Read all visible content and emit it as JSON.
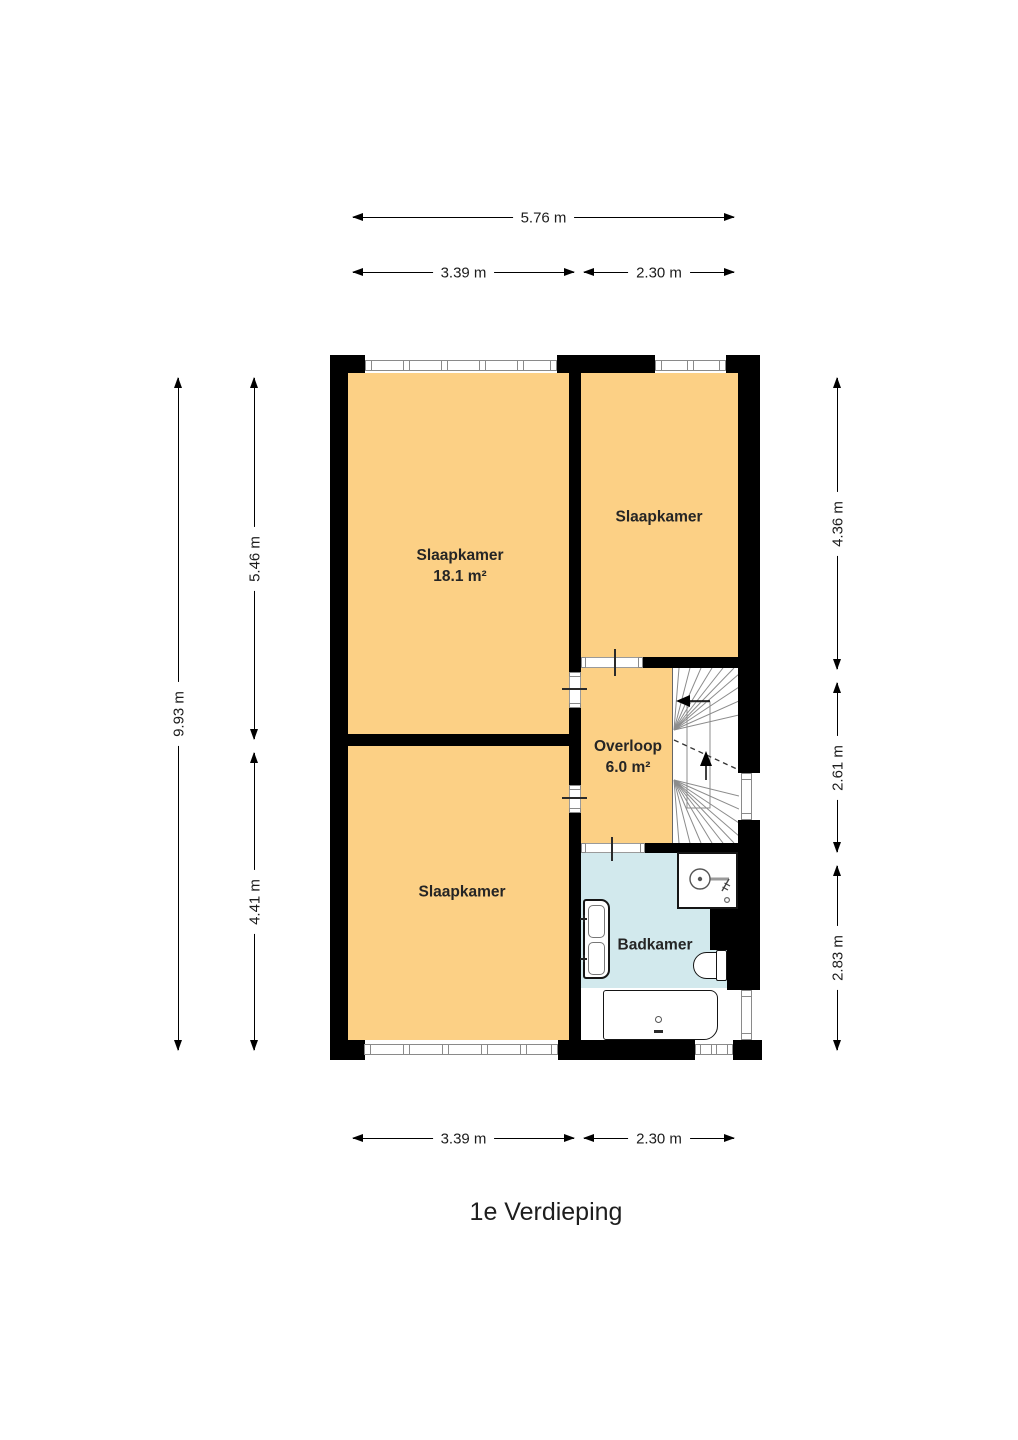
{
  "title": "1e Verdieping",
  "colors": {
    "room": "#FCD085",
    "bathroom": "#D2E9ED",
    "wall": "#000000"
  },
  "rooms": {
    "bedroom_large": {
      "name": "Slaapkamer",
      "area": "18.1 m²"
    },
    "bedroom_right": {
      "name": "Slaapkamer"
    },
    "bedroom_bottom": {
      "name": "Slaapkamer"
    },
    "landing": {
      "name": "Overloop",
      "area": "6.0 m²"
    },
    "bathroom": {
      "name": "Badkamer"
    }
  },
  "dimensions": {
    "top_total": "5.76 m",
    "top_left": "3.39 m",
    "top_right": "2.30 m",
    "bottom_left": "3.39 m",
    "bottom_right": "2.30 m",
    "left_total": "9.93 m",
    "left_upper": "5.46 m",
    "left_lower": "4.41 m",
    "right_upper": "4.36 m",
    "right_middle": "2.61 m",
    "right_lower": "2.83 m"
  },
  "fixtures": {
    "stairs": "staircase",
    "shower": "shower",
    "sink": "double-washbasin",
    "toilet": "toilet",
    "bathtub": "bathtub"
  }
}
